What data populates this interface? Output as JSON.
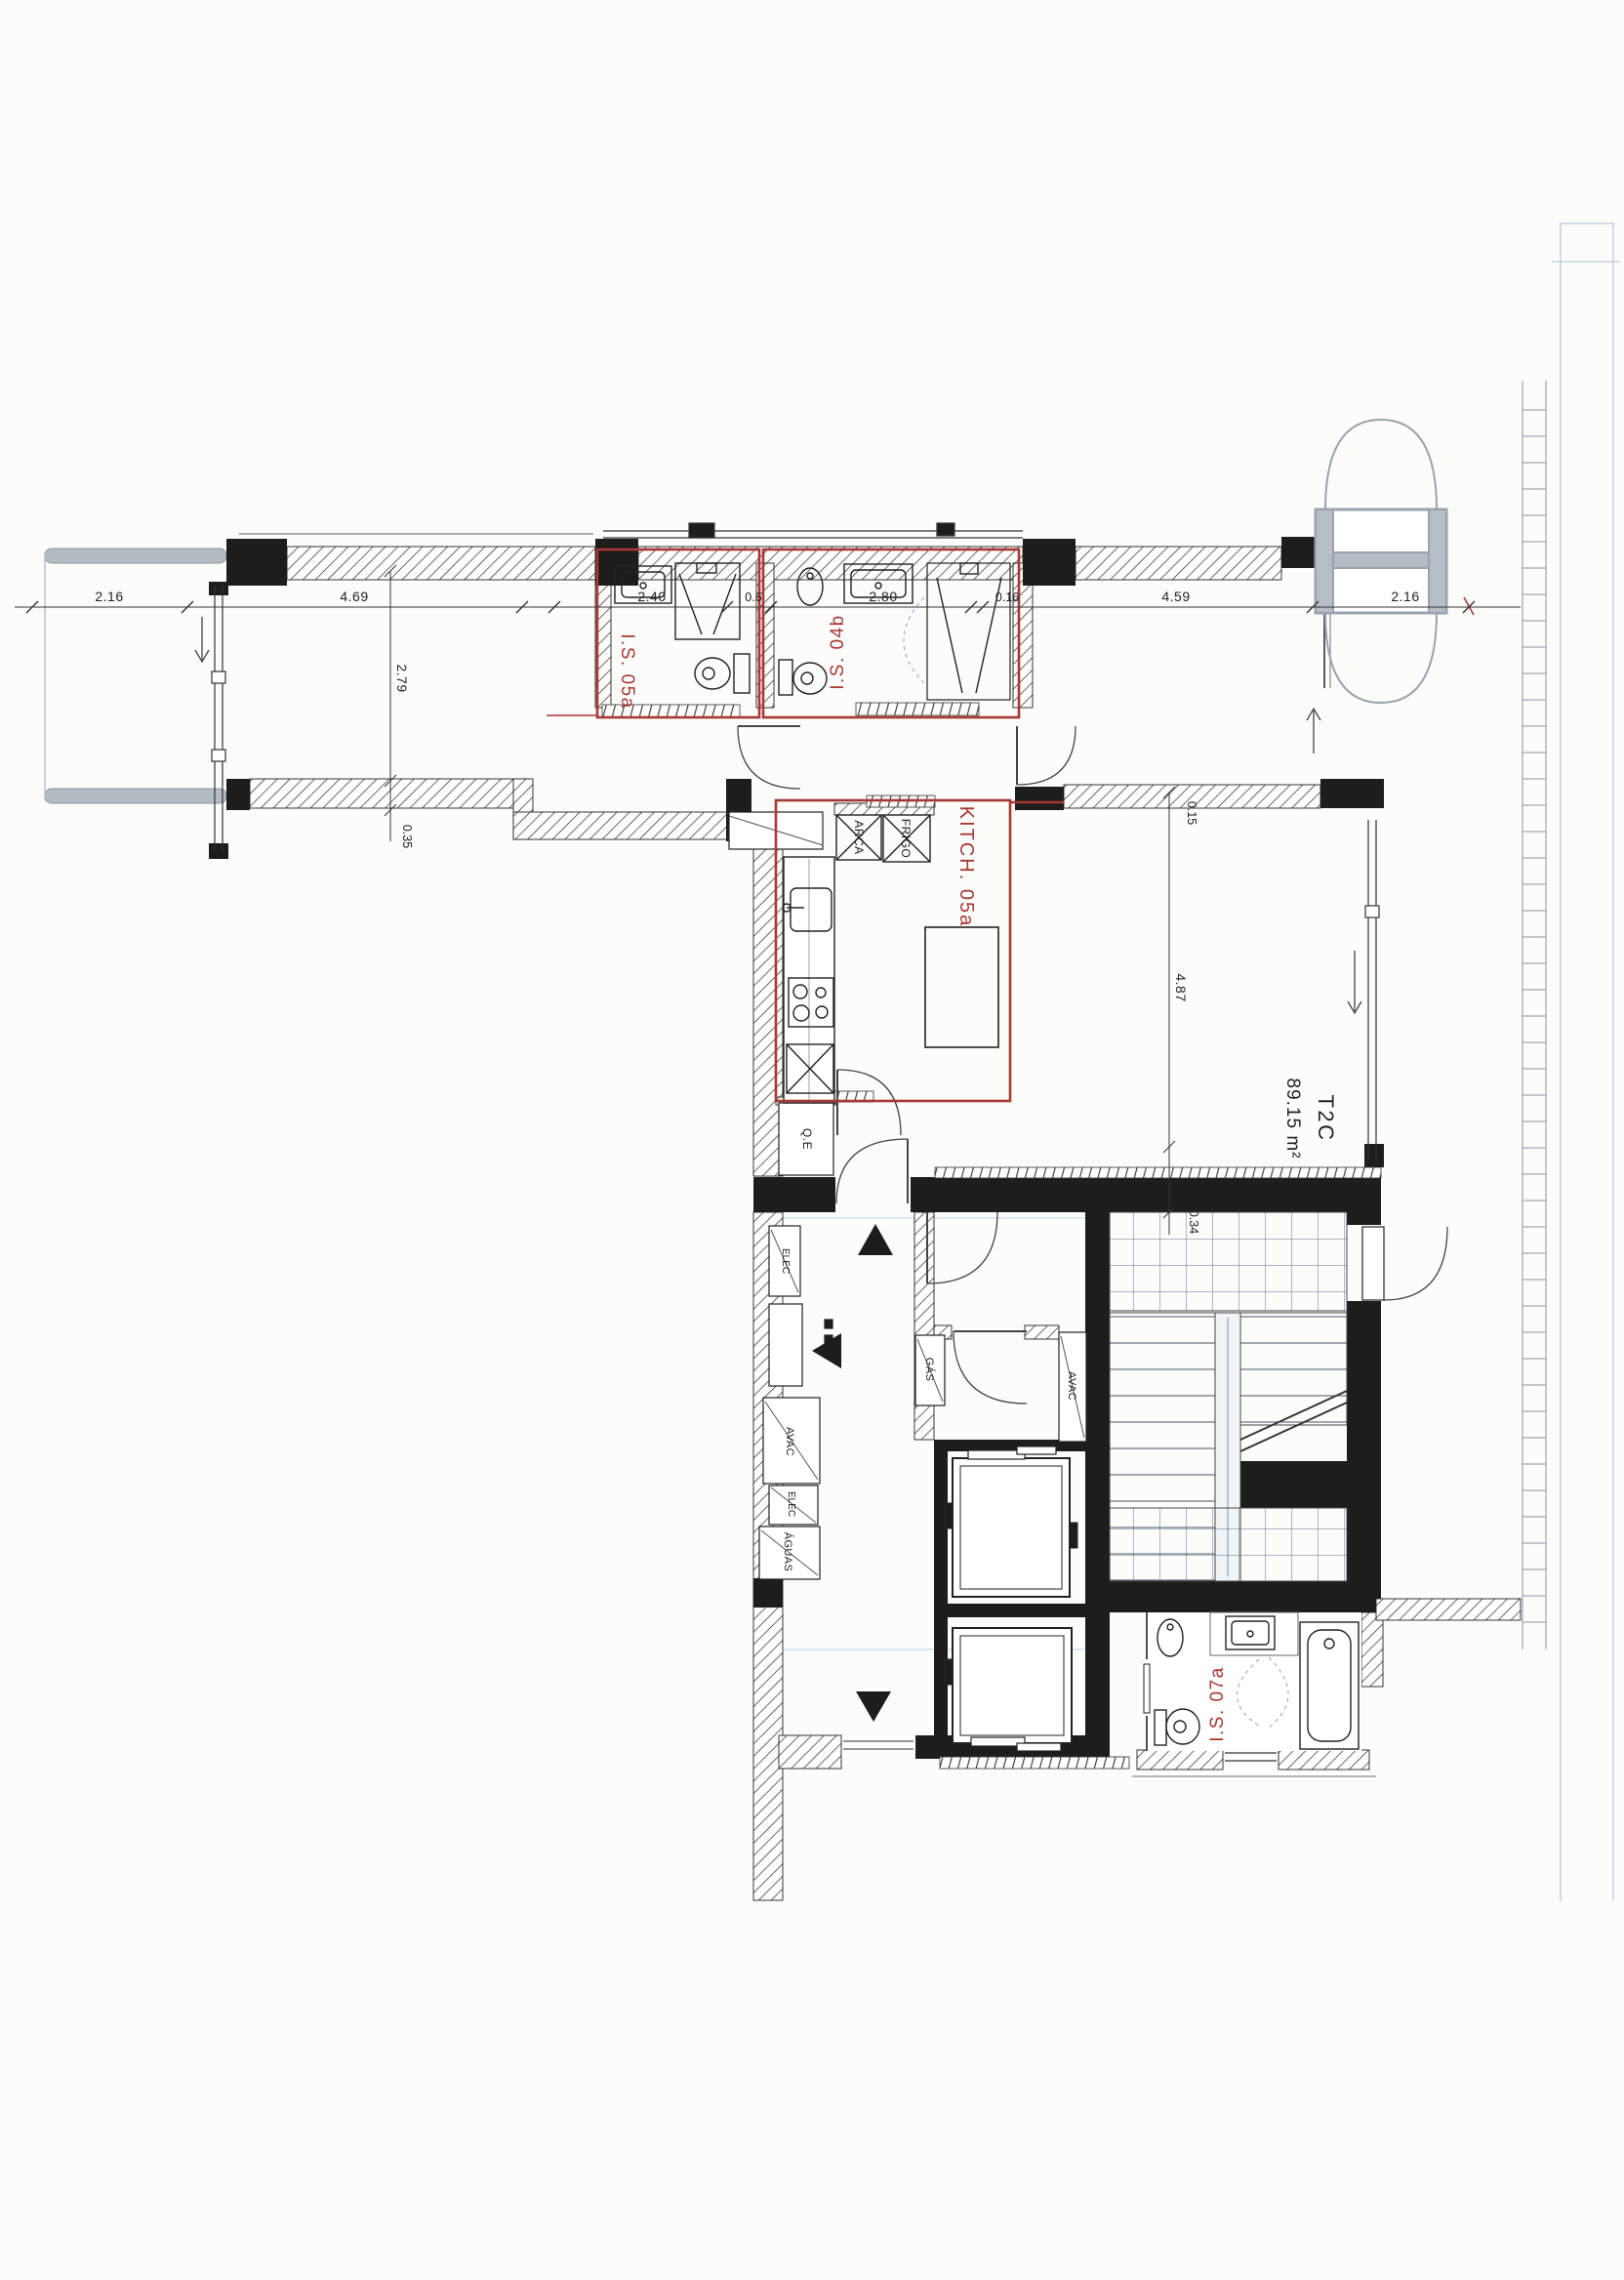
{
  "plan": {
    "apartment": {
      "code": "T2C",
      "area": "89.15 m²"
    },
    "rooms": {
      "is05a": "I.S. 05a",
      "is04b": "I.S. 04b",
      "kitchen": "KITCH. 05a",
      "is07a": "I.S. 07a"
    },
    "appliances": {
      "arca": "ARCA",
      "frigo": "FRIGO"
    },
    "shafts": {
      "qe": "Q.E",
      "elec_hall": "ELEC",
      "gas": "GÁS",
      "avac_core": "AVAC",
      "avac_riser": "AVAC",
      "elec_riser": "ELEC",
      "aguas": "ÁGUAS"
    },
    "dimensions": {
      "terrace_left": "2.16",
      "room_left_width": "4.69",
      "bath1_width": "2.40",
      "shaft_width": "0.6",
      "bath2_width": "2.80",
      "wall_right": "0.16",
      "living_width": "4.59",
      "terrace_right": "2.16",
      "room_left_depth": "2.79",
      "step_depth": "0.35",
      "wall_top": "0.15",
      "living_depth": "4.87",
      "landing_depth": "0.34"
    },
    "colors": {
      "highlight_red": "#a83832",
      "wall_black": "#1d1d1b",
      "fixture_gray": "#9aa3ad",
      "rail_gray": "#b4bcc3",
      "scan_blue": "#c6d2e0"
    }
  }
}
